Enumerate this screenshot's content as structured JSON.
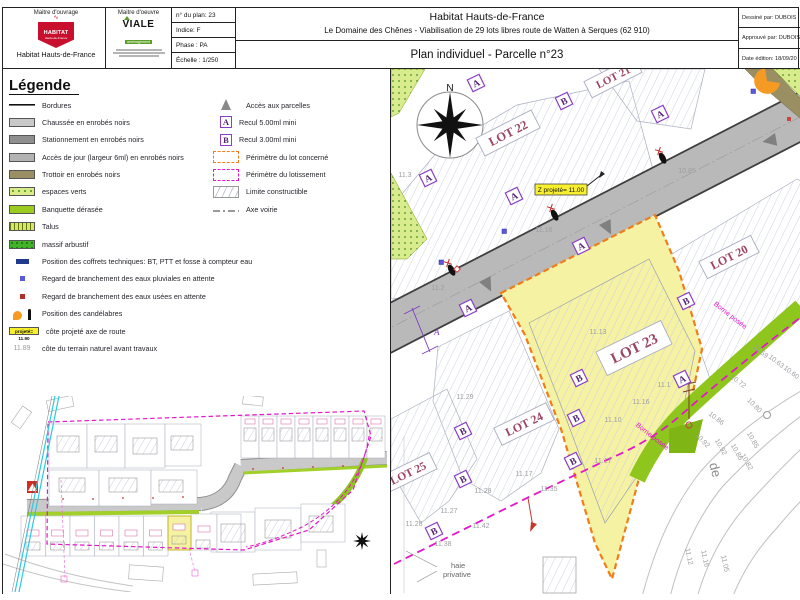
{
  "title_block": {
    "mo_label": "Maitre d'ouvrage",
    "mo_logo_text": "HABITAT",
    "mo_logo_sub": "Hauts-de-France",
    "mo_name": "Habitat Hauts-de-France",
    "moe_label": "Maitre d'oeuvre",
    "moe_logo_text": "VIALE",
    "moe_logo_sub": "aménagement",
    "plan_no": "n° du plan: 23",
    "indice": "Indice: F",
    "phase": "Phase : PA",
    "echelle": "Échelle : 1/250",
    "org": "Habitat Hauts-de-France",
    "desc": "Le Domaine des Chênes - Viabilisation de 29 lots libres route de Watten à Serques (62 910)",
    "sheet_title": "Plan individuel - Parcelle n°23",
    "drawn_by": "Dessiné par: DUBOIS",
    "approved_by": "Approuvé par: DUBOIS",
    "date_edition": "Date édition: 18/09/20"
  },
  "legend": {
    "title": "Légende",
    "items_left": [
      {
        "type": "bordure",
        "label": "Bordures"
      },
      {
        "type": "chaussee",
        "label": "Chaussée en enrobés noirs"
      },
      {
        "type": "stationnement",
        "label": "Stationnement en enrobés noirs"
      },
      {
        "type": "acces",
        "label": "Accès de jour (largeur 6ml) en enrobés noirs"
      },
      {
        "type": "trottoir",
        "label": "Trottoir en enrobés noirs"
      },
      {
        "type": "espaces",
        "label": "espaces verts"
      },
      {
        "type": "banquette",
        "label": "Banquette dérasée"
      },
      {
        "type": "talus",
        "label": "Talus"
      },
      {
        "type": "massif",
        "label": "massif arbustif"
      },
      {
        "type": "coffrets",
        "label": "Position des coffrets techniques: BT, PTT et fosse à compteur eau"
      },
      {
        "type": "pluvial",
        "label": "Regard de branchement des eaux pluviales en attente"
      },
      {
        "type": "usees",
        "label": "Regard de branchement des eaux usées en attente"
      },
      {
        "type": "candelabre",
        "label": "Position des candélabres"
      },
      {
        "type": "cote_proj",
        "label": "côte projeté axe de route",
        "box_text": "projeté= 11.90"
      },
      {
        "type": "cote_nat",
        "label": "côte du terrain naturel avant travaux",
        "prefix": "11.89"
      }
    ],
    "items_right": [
      {
        "type": "triangle",
        "label": "Accès aux parcelles"
      },
      {
        "type": "recul_a",
        "label": "Recul 5.00ml mini",
        "glyph": "A"
      },
      {
        "type": "recul_b",
        "label": "Recul 3.00ml mini",
        "glyph": "B"
      },
      {
        "type": "perim_lot",
        "label": "Périmètre du lot concerné"
      },
      {
        "type": "perim_lotissement",
        "label": "Périmètre du lotissement"
      },
      {
        "type": "limite",
        "label": "Limite constructible"
      },
      {
        "type": "axe",
        "label": "Axe voirie"
      }
    ]
  },
  "plan": {
    "north": "N",
    "z_label": "Z projeté= 11.00",
    "borne_1": "Borne posée",
    "borne_2": "Borne posée",
    "haie_1": "haie",
    "haie_2": "privative",
    "street": "de",
    "recul_dim": "A",
    "lots": [
      {
        "name": "LOT 22",
        "x": 507,
        "y": 132,
        "rot": -27,
        "w": 62,
        "h": 20,
        "fs": 12.5
      },
      {
        "name": "LOT 21",
        "x": 612,
        "y": 76,
        "rot": -27,
        "w": 56,
        "h": 18,
        "fs": 11
      },
      {
        "name": "LOT 20",
        "x": 728,
        "y": 256,
        "rot": -27,
        "w": 58,
        "h": 19,
        "fs": 12
      },
      {
        "name": "LOT 23",
        "x": 633,
        "y": 347,
        "rot": -26,
        "w": 72,
        "h": 26,
        "fs": 15
      },
      {
        "name": "LOT 24",
        "x": 523,
        "y": 423,
        "rot": -26,
        "w": 58,
        "h": 19,
        "fs": 12
      },
      {
        "name": "LOT 25",
        "x": 407,
        "y": 472,
        "rot": -26,
        "w": 56,
        "h": 18,
        "fs": 11.5
      }
    ],
    "markers_a": [
      [
        427,
        177
      ],
      [
        475,
        82
      ],
      [
        513,
        195
      ],
      [
        467,
        307
      ],
      [
        580,
        245
      ],
      [
        659,
        113
      ],
      [
        681,
        378
      ]
    ],
    "markers_b": [
      [
        563,
        100
      ],
      [
        685,
        300
      ],
      [
        578,
        377
      ],
      [
        575,
        417
      ],
      [
        462,
        430
      ],
      [
        462,
        478
      ],
      [
        433,
        530
      ],
      [
        572,
        460
      ]
    ],
    "cotes": [
      {
        "t": "11.3",
        "x": 404,
        "y": 176,
        "r": 0
      },
      {
        "t": "11.2",
        "x": 437,
        "y": 289,
        "r": 0
      },
      {
        "t": "11.16",
        "x": 543,
        "y": 231,
        "r": 0
      },
      {
        "t": "10.85",
        "x": 686,
        "y": 172,
        "r": 0
      },
      {
        "t": "11.13",
        "x": 597,
        "y": 333,
        "r": 0
      },
      {
        "t": "11.1",
        "x": 663,
        "y": 386,
        "r": 0
      },
      {
        "t": "11.16",
        "x": 640,
        "y": 403,
        "r": 0
      },
      {
        "t": "11.10",
        "x": 612,
        "y": 421,
        "r": 0
      },
      {
        "t": "11.29",
        "x": 464,
        "y": 398,
        "r": 0
      },
      {
        "t": "11.28",
        "x": 413,
        "y": 525,
        "r": 0
      },
      {
        "t": "11.27",
        "x": 448,
        "y": 512,
        "r": 0
      },
      {
        "t": "11.38",
        "x": 442,
        "y": 545,
        "r": 0
      },
      {
        "t": "11.42",
        "x": 480,
        "y": 527,
        "r": 0
      },
      {
        "t": "11.28",
        "x": 482,
        "y": 492,
        "r": 0
      },
      {
        "t": "11.17",
        "x": 523,
        "y": 475,
        "r": 0
      },
      {
        "t": "11.35",
        "x": 548,
        "y": 490,
        "r": 0
      },
      {
        "t": "11.17",
        "x": 602,
        "y": 462,
        "r": 0
      },
      {
        "t": "10.59",
        "x": 758,
        "y": 352,
        "r": 38
      },
      {
        "t": "10.63",
        "x": 774,
        "y": 362,
        "r": 38
      },
      {
        "t": "10.60",
        "x": 789,
        "y": 373,
        "r": 38
      },
      {
        "t": "10.72",
        "x": 736,
        "y": 382,
        "r": 38
      },
      {
        "t": "10.80",
        "x": 752,
        "y": 406,
        "r": 45
      },
      {
        "t": "10.86",
        "x": 714,
        "y": 419,
        "r": 38
      },
      {
        "t": "10.92",
        "x": 700,
        "y": 441,
        "r": 45
      },
      {
        "t": "10.92",
        "x": 718,
        "y": 447,
        "r": 60
      },
      {
        "t": "10.86",
        "x": 734,
        "y": 452,
        "r": 60
      },
      {
        "t": "10.85",
        "x": 750,
        "y": 440,
        "r": 60
      },
      {
        "t": "10.82",
        "x": 744,
        "y": 462,
        "r": 60
      },
      {
        "t": "11.12",
        "x": 686,
        "y": 556,
        "r": 78
      },
      {
        "t": "11.16",
        "x": 702,
        "y": 558,
        "r": 78
      },
      {
        "t": "11.05",
        "x": 722,
        "y": 563,
        "r": 78
      }
    ]
  }
}
